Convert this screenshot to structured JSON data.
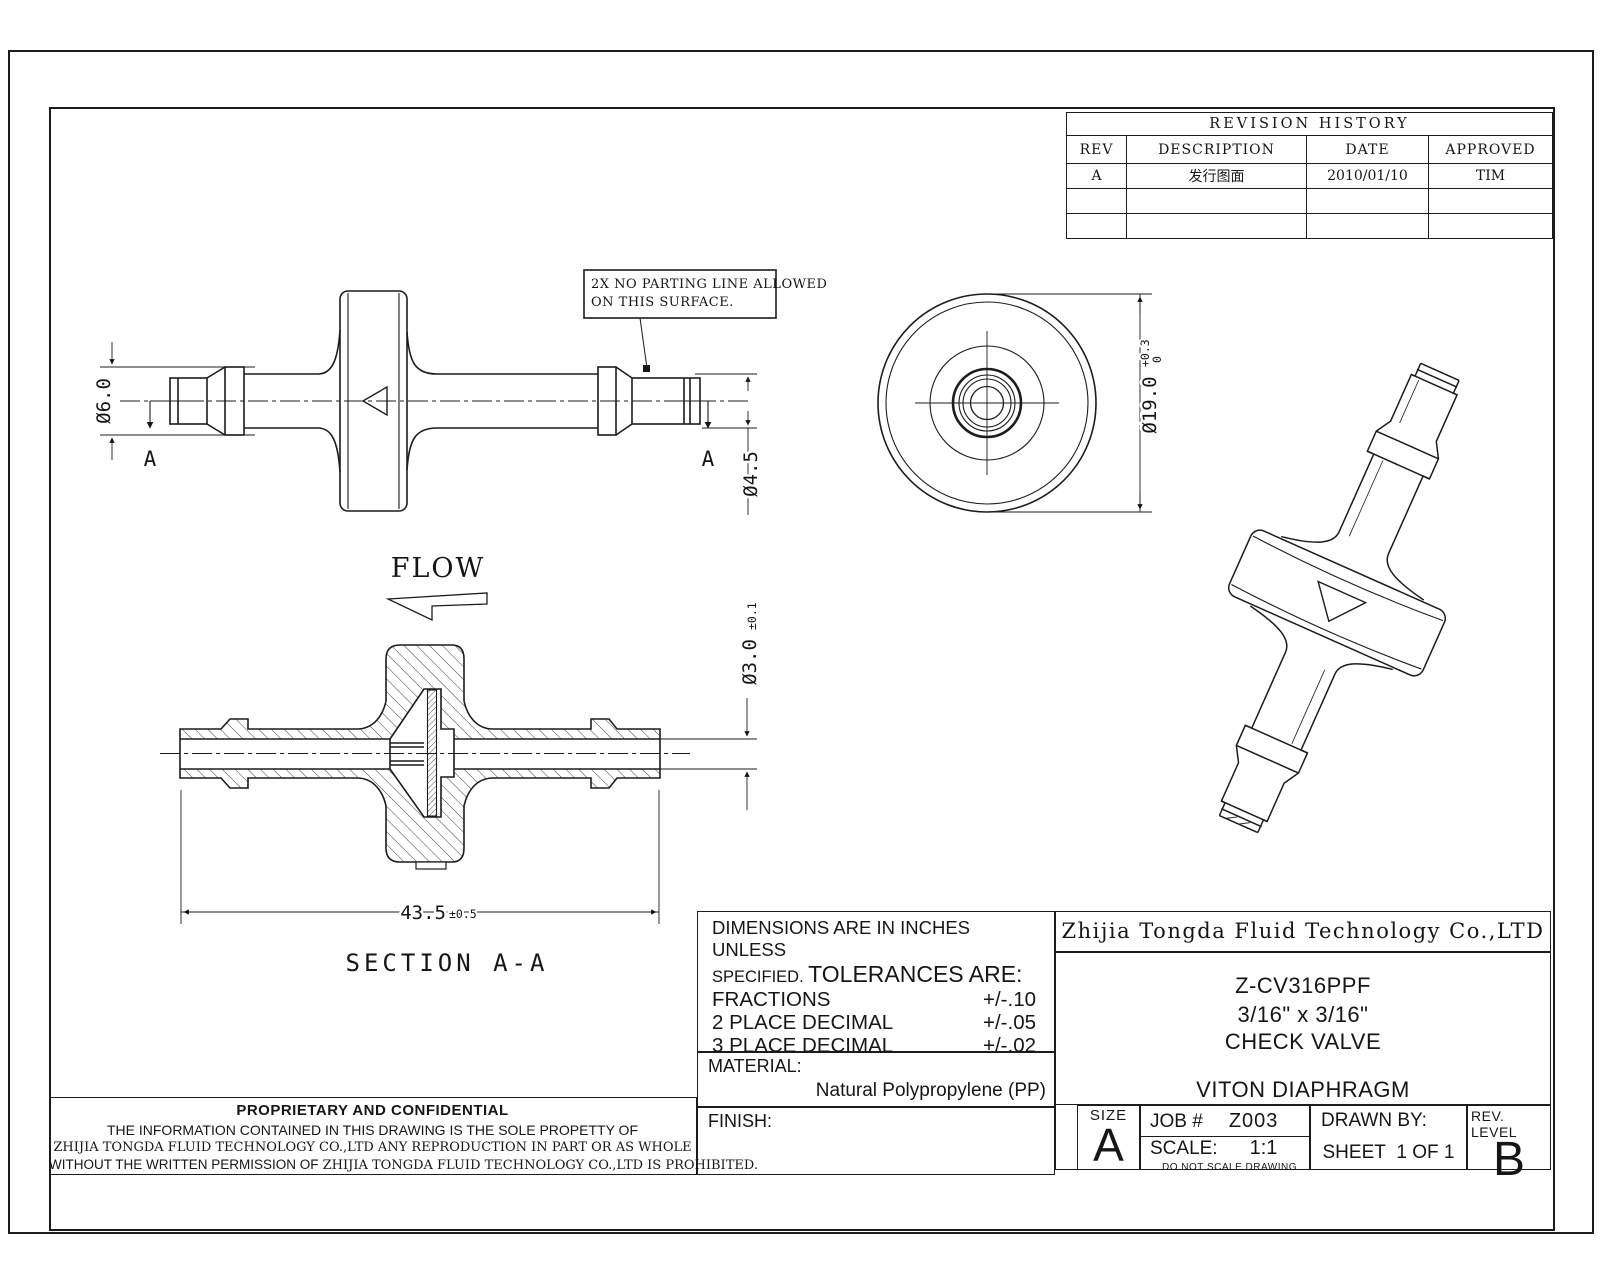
{
  "revision_table": {
    "title": "REVISION HISTORY",
    "headers": [
      "REV",
      "DESCRIPTION",
      "DATE",
      "APPROVED"
    ],
    "rows": [
      {
        "rev": "A",
        "description": "发行图面",
        "date": "2010/01/10",
        "approved": "TIM"
      }
    ]
  },
  "notes": {
    "line1": "2X NO PARTING LINE ALLOWED",
    "line2": "ON THIS SURFACE."
  },
  "dims": {
    "d6": "Ø6.0",
    "d45": "Ø4.5",
    "d19": "Ø19.0",
    "d19_sup": "+0.3",
    "d19_sub": "0",
    "d3": "Ø3.0",
    "d3_tol": "±0.1",
    "len": "43.5",
    "len_tol": "±0.5"
  },
  "labels": {
    "flow": "FLOW",
    "section": "SECTION A-A",
    "a_left": "A",
    "a_right": "A"
  },
  "tolerance_block": {
    "line1": "DIMENSIONS ARE IN INCHES UNLESS",
    "line2_small": "SPECIFIED.",
    "line2_big": "TOLERANCES ARE:",
    "rows": [
      [
        "FRACTIONS",
        "+/-.10"
      ],
      [
        "2 PLACE DECIMAL",
        "+/-.05"
      ],
      [
        "3 PLACE DECIMAL",
        "+/-.02"
      ],
      [
        "ANGLES",
        "NOTED"
      ]
    ]
  },
  "material_block": {
    "label": "MATERIAL:",
    "value": "Natural Polypropylene (PP)"
  },
  "finish_block": {
    "label": "FINISH:"
  },
  "title_block": {
    "company": "Zhijia Tongda Fluid Technology Co.,LTD",
    "part_number": "Z-CV316PPF",
    "size_desc": "3/16\" x 3/16\"",
    "part_name": "CHECK VALVE",
    "material_note": "VITON DIAPHRAGM",
    "size_label": "SIZE",
    "size_value": "A",
    "job_label": "JOB #",
    "job_value": "Z003",
    "scale_label": "SCALE:",
    "scale_value": "1:1",
    "scale_note": "DO NOT SCALE DRAWING",
    "drawn_by_label": "DRAWN BY:",
    "sheet_label": "SHEET",
    "sheet_value": "1 OF 1",
    "rev_label": "REV. LEVEL",
    "rev_value": "B"
  },
  "proprietary": {
    "title": "PROPRIETARY AND CONFIDENTIAL",
    "line1": "THE INFORMATION CONTAINED IN THIS DRAWING IS THE SOLE PROPETTY OF",
    "line2": "ZHIJIA TONGDA FLUID TECHNOLOGY CO.,LTD ANY REPRODUCTION IN PART OR AS WHOLE",
    "line3a": "WITHOUT THE WRITTEN PERMISSION OF",
    "line3b": " ZHIJIA TONGDA FLUID TECHNOLOGY CO.,LTD IS PROHIBITED."
  }
}
